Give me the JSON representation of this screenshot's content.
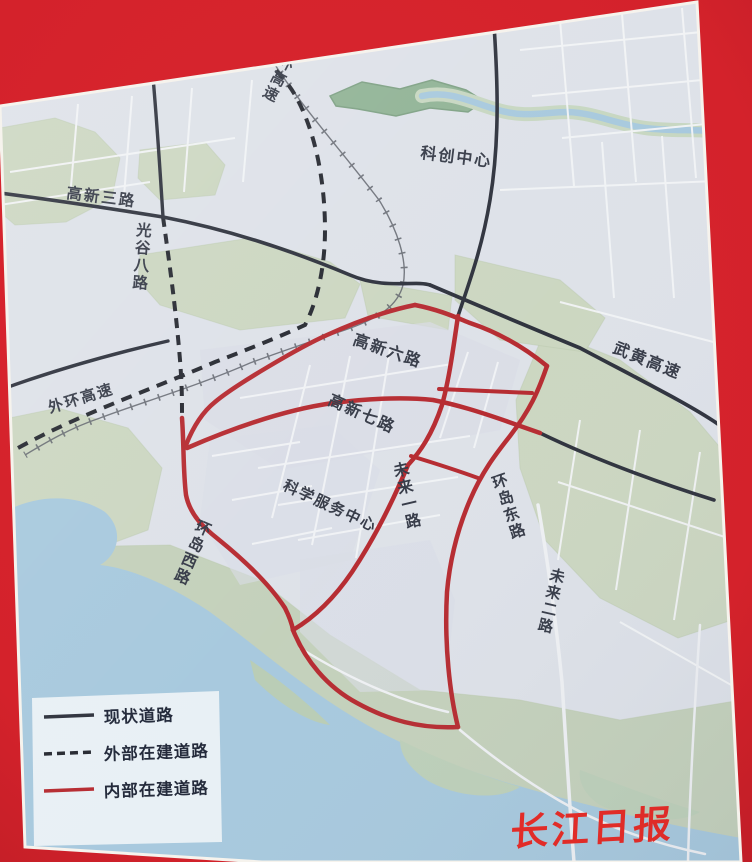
{
  "map": {
    "road_labels": {
      "gaoxin_san_lu": "高新三路",
      "guanggu_ba_lu": "光谷八路",
      "waihuan_gaosu_west": "外环高速",
      "waihuan_gaosu_top": "环高速",
      "kechuang_zhongxin": "科创中心",
      "gaoxin_liu_lu": "高新六路",
      "gaoxin_qi_lu": "高新七路",
      "weilai_yi_lu": "未来一路",
      "huandao_dong_lu": "环岛东路",
      "huandao_xi_lu": "环岛西路",
      "kexue_fuwu_zhongxin": "科学服务中心",
      "wuhuang_gaosu": "武黄高速",
      "weilai_er_lu": "未来二路"
    }
  },
  "legend": {
    "items": [
      {
        "label": "现状道路",
        "line_style": "solid",
        "line_color": "#2b2f3a"
      },
      {
        "label": "外部在建道路",
        "line_style": "dashed",
        "line_color": "#23262e"
      },
      {
        "label": "内部在建道路",
        "line_style": "solid",
        "line_color": "#b5282e"
      }
    ]
  },
  "watermark": {
    "text": "长江日报",
    "color": "#e6231d"
  },
  "colors": {
    "background_red": "#d4222b",
    "map_base": "#dde1e8",
    "park_green": "#cbd6c0",
    "park_dark_green": "#8fb294",
    "water_blue": "#a6c8dd",
    "existing_road_black": "#2b2f3a",
    "internal_construction_red": "#b5282e",
    "external_construction_black": "#23262e",
    "street_grid": "#f2f4f6"
  }
}
